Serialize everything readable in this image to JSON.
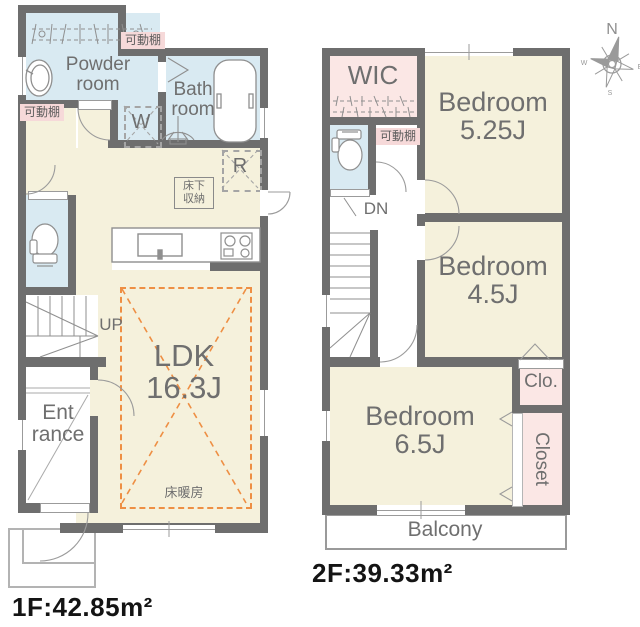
{
  "floor1": {
    "area_label": "1F:42.85m²",
    "rooms": {
      "powder_room": {
        "line1": "Powder",
        "line2": "room"
      },
      "bath_room": {
        "line1": "Bath",
        "line2": "room"
      },
      "ldk": {
        "line1": "LDK",
        "line2": "16.3J"
      },
      "entrance": {
        "line1": "Ent",
        "line2": "rance"
      }
    },
    "labels": {
      "shelf_top": "可動棚",
      "shelf_left": "可動棚",
      "washer": "W",
      "fridge": "R",
      "underfloor_storage_line1": "床下",
      "underfloor_storage_line2": "収納",
      "floor_heating": "床暖房",
      "stairs_up": "UP"
    }
  },
  "floor2": {
    "area_label": "2F:39.33m²",
    "rooms": {
      "wic": "WIC",
      "bedroom_525": {
        "line1": "Bedroom",
        "line2": "5.25J"
      },
      "bedroom_45": {
        "line1": "Bedroom",
        "line2": "4.5J"
      },
      "bedroom_65": {
        "line1": "Bedroom",
        "line2": "6.5J"
      },
      "clo": "Clo.",
      "closet": "Closet",
      "balcony": "Balcony"
    },
    "labels": {
      "shelf": "可動棚",
      "stairs_down": "DN"
    }
  },
  "compass": {
    "north": "N",
    "west": "W",
    "east": "E",
    "south": "S"
  },
  "colors": {
    "wall": "#6e6e6e",
    "room_cream": "#f5f1dc",
    "room_blue": "#d9eaf2",
    "room_pink": "#fbe7e5",
    "heating_orange": "#ee8f44",
    "label_gray": "#6f6f6f"
  }
}
